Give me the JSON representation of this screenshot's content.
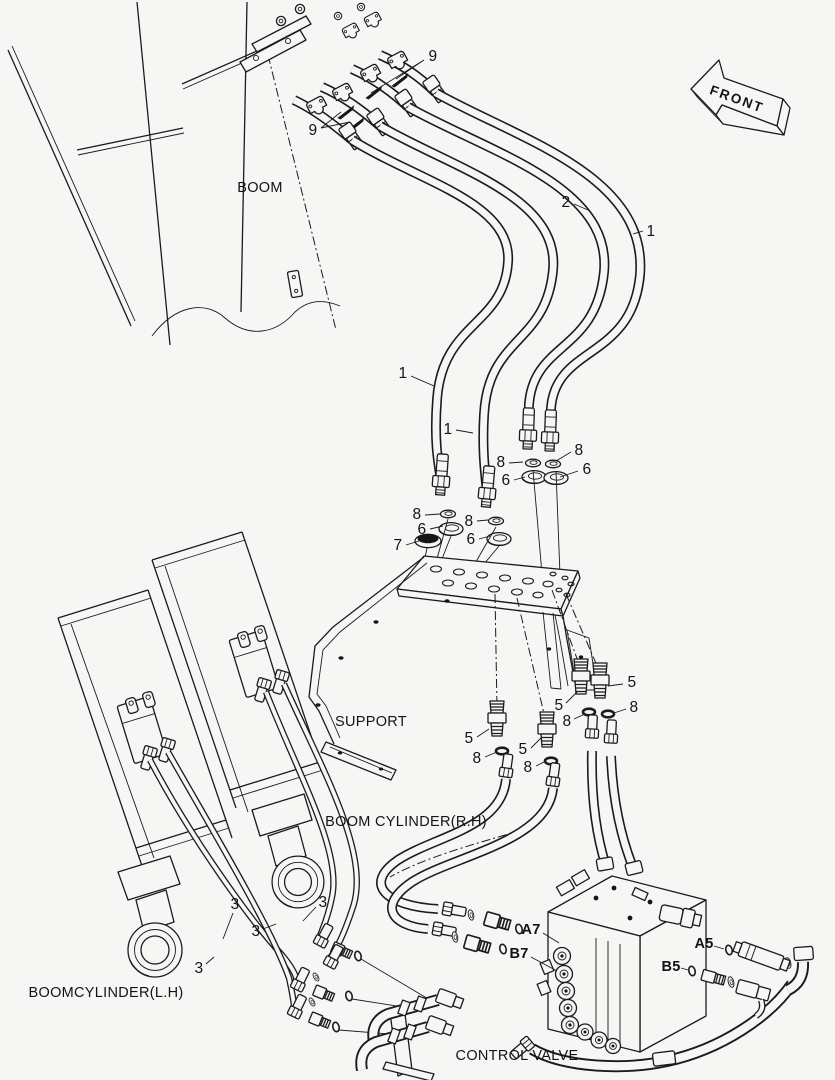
{
  "colors": {
    "background": "#f6f6f5",
    "line": "#1b1b1b"
  },
  "diagram": {
    "text_labels": [
      {
        "id": "boom",
        "text": "BOOM",
        "x": 260,
        "y": 188
      },
      {
        "id": "front",
        "text": "FRONT",
        "x": 737,
        "y": 99,
        "rotate": 20
      },
      {
        "id": "support",
        "text": "SUPPORT",
        "x": 371,
        "y": 722
      },
      {
        "id": "boom-cylinder-rh",
        "text": "BOOM CYLINDER(R.H)",
        "x": 406,
        "y": 822
      },
      {
        "id": "boom-cylinder-lh",
        "text": "BOOMCYLINDER(L.H)",
        "x": 106,
        "y": 993
      },
      {
        "id": "control-valve",
        "text": "CONTROL VALVE",
        "x": 517,
        "y": 1056
      }
    ],
    "port_labels": [
      {
        "id": "a7",
        "text": "A7",
        "x": 531,
        "y": 930
      },
      {
        "id": "b7",
        "text": "B7",
        "x": 519,
        "y": 954
      },
      {
        "id": "a5",
        "text": "A5",
        "x": 704,
        "y": 944
      },
      {
        "id": "b5",
        "text": "B5",
        "x": 671,
        "y": 967
      }
    ],
    "callouts": [
      {
        "text": "9",
        "x": 433,
        "y": 57
      },
      {
        "text": "9",
        "x": 313,
        "y": 131
      },
      {
        "text": "2",
        "x": 566,
        "y": 203
      },
      {
        "text": "1",
        "x": 651,
        "y": 232
      },
      {
        "text": "1",
        "x": 403,
        "y": 374
      },
      {
        "text": "1",
        "x": 448,
        "y": 430
      },
      {
        "text": "8",
        "x": 501,
        "y": 463
      },
      {
        "text": "6",
        "x": 506,
        "y": 481
      },
      {
        "text": "8",
        "x": 579,
        "y": 451
      },
      {
        "text": "6",
        "x": 587,
        "y": 470
      },
      {
        "text": "8",
        "x": 417,
        "y": 515
      },
      {
        "text": "6",
        "x": 422,
        "y": 530
      },
      {
        "text": "7",
        "x": 398,
        "y": 546
      },
      {
        "text": "8",
        "x": 469,
        "y": 522
      },
      {
        "text": "6",
        "x": 471,
        "y": 540
      },
      {
        "text": "5",
        "x": 632,
        "y": 683
      },
      {
        "text": "8",
        "x": 634,
        "y": 708
      },
      {
        "text": "5",
        "x": 559,
        "y": 706
      },
      {
        "text": "8",
        "x": 567,
        "y": 722
      },
      {
        "text": "5",
        "x": 469,
        "y": 739
      },
      {
        "text": "8",
        "x": 477,
        "y": 759
      },
      {
        "text": "5",
        "x": 523,
        "y": 750
      },
      {
        "text": "8",
        "x": 528,
        "y": 768
      },
      {
        "text": "3",
        "x": 235,
        "y": 905
      },
      {
        "text": "3",
        "x": 323,
        "y": 903
      },
      {
        "text": "3",
        "x": 256,
        "y": 932
      },
      {
        "text": "3",
        "x": 199,
        "y": 969
      }
    ]
  }
}
